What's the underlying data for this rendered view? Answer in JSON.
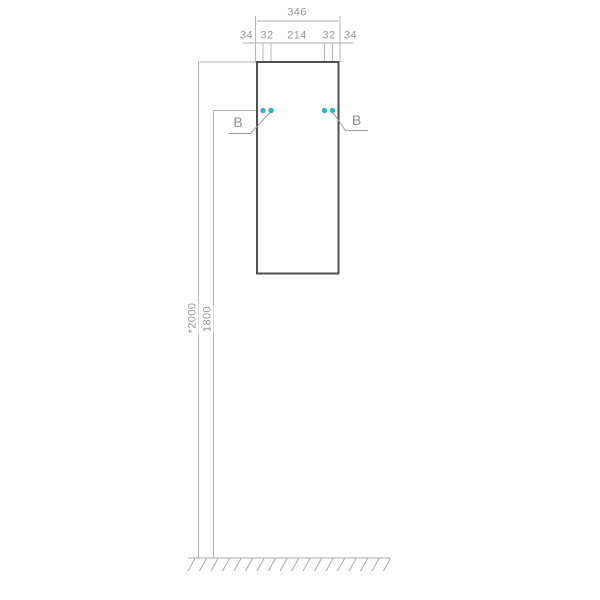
{
  "diagram": {
    "kind": "cabinet-installation-drawing",
    "dim_total_width": "346",
    "dim_chain": [
      "34",
      "32",
      "214",
      "32",
      "34"
    ],
    "dim_height_overall": "*2000",
    "dim_height_holes": "1800",
    "section_marks": {
      "left": "B",
      "right": "B"
    }
  },
  "colors": {
    "hole_accent": "#2eb1c9",
    "cabinet_line": "#4f4f4f",
    "dim_line": "#aeaeae",
    "text": "#969696"
  }
}
